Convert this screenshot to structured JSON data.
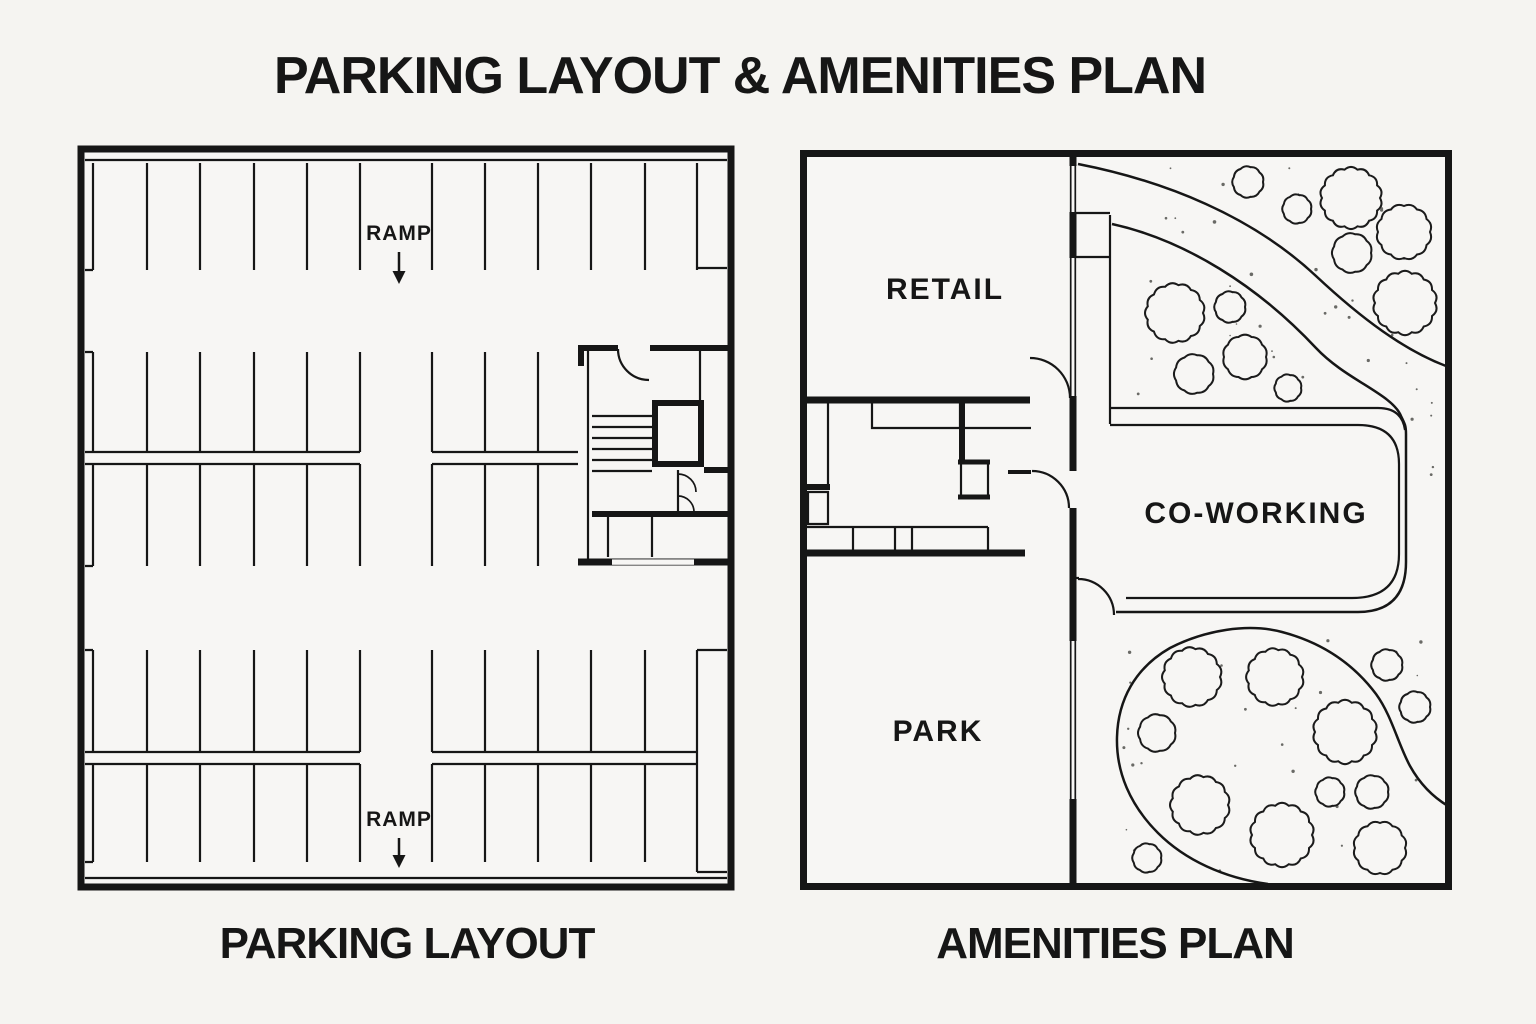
{
  "title": "PARKING LAYOUT & AMENITIES PLAN",
  "parking": {
    "caption": "PARKING LAYOUT",
    "ramp_top": "RAMP",
    "ramp_bottom": "RAMP"
  },
  "amenities": {
    "caption": "AMENITIES PLAN",
    "retail": "RETAIL",
    "coworking": "CO-WORKING",
    "park": "PARK",
    "trees": [
      {
        "cx": 1248,
        "cy": 182,
        "r": 15
      },
      {
        "cx": 1297,
        "cy": 209,
        "r": 14
      },
      {
        "cx": 1351,
        "cy": 198,
        "r": 29
      },
      {
        "cx": 1404,
        "cy": 232,
        "r": 26
      },
      {
        "cx": 1352,
        "cy": 253,
        "r": 19
      },
      {
        "cx": 1405,
        "cy": 303,
        "r": 30
      },
      {
        "cx": 1175,
        "cy": 313,
        "r": 28
      },
      {
        "cx": 1230,
        "cy": 307,
        "r": 15
      },
      {
        "cx": 1245,
        "cy": 357,
        "r": 21
      },
      {
        "cx": 1194,
        "cy": 374,
        "r": 19
      },
      {
        "cx": 1288,
        "cy": 388,
        "r": 13
      },
      {
        "cx": 1192,
        "cy": 677,
        "r": 28
      },
      {
        "cx": 1275,
        "cy": 677,
        "r": 27
      },
      {
        "cx": 1157,
        "cy": 733,
        "r": 18
      },
      {
        "cx": 1345,
        "cy": 732,
        "r": 30
      },
      {
        "cx": 1200,
        "cy": 805,
        "r": 28
      },
      {
        "cx": 1282,
        "cy": 835,
        "r": 30
      },
      {
        "cx": 1330,
        "cy": 792,
        "r": 14
      },
      {
        "cx": 1372,
        "cy": 792,
        "r": 16
      },
      {
        "cx": 1380,
        "cy": 848,
        "r": 25
      },
      {
        "cx": 1147,
        "cy": 858,
        "r": 14
      },
      {
        "cx": 1387,
        "cy": 665,
        "r": 15
      },
      {
        "cx": 1415,
        "cy": 707,
        "r": 15
      }
    ],
    "stipple_regions": [
      {
        "x": 1150,
        "y": 163,
        "w": 285,
        "h": 205,
        "n": 26
      },
      {
        "x": 1120,
        "y": 270,
        "w": 185,
        "h": 130,
        "n": 12
      },
      {
        "x": 1112,
        "y": 635,
        "w": 325,
        "h": 238,
        "n": 32
      },
      {
        "x": 1412,
        "y": 385,
        "w": 28,
        "h": 235,
        "n": 6
      }
    ]
  },
  "colors": {
    "background": "#f5f4f1",
    "paper": "#f7f6f4",
    "ink": "#161616"
  }
}
